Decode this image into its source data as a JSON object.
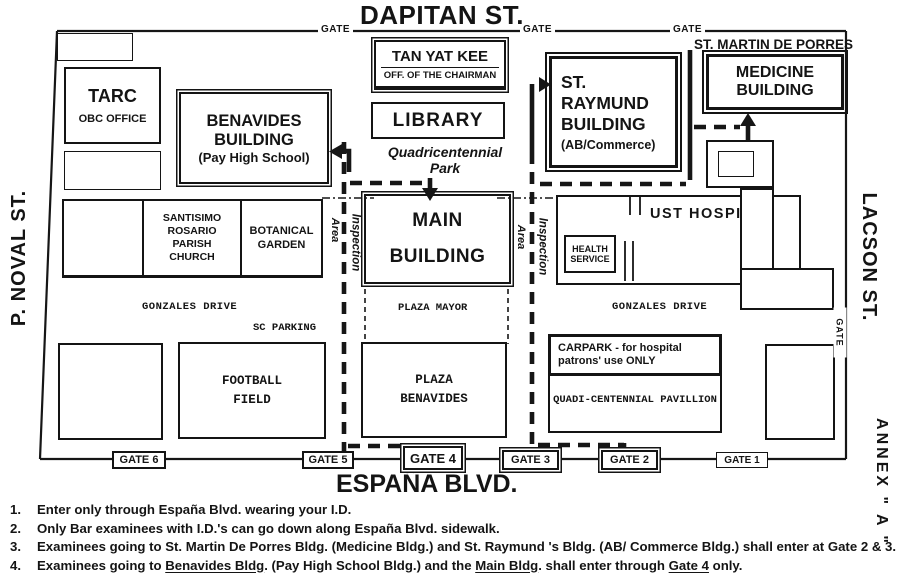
{
  "streets": {
    "top": "DAPITAN ST.",
    "bottom": "ESPAÑA BLVD.",
    "left": "P. NOVAL ST.",
    "right": "LACSON ST.",
    "annex": "ANNEX \" A \"",
    "side_gate": "GATE"
  },
  "top_gates": [
    "GATE",
    "GATE",
    "GATE"
  ],
  "buildings": {
    "tarc": {
      "line1": "TARC",
      "line2": "OBC OFFICE"
    },
    "benavides": {
      "line1": "BENAVIDES",
      "line2": "BUILDING",
      "line3": "(Pay High School)"
    },
    "tan_yat_kee": {
      "line1": "TAN YAT KEE",
      "line2": "OFF. OF THE CHAIRMAN"
    },
    "library": "LIBRARY",
    "st_raymund": {
      "line1": "ST.",
      "line2": "RAYMUND",
      "line3": "BUILDING",
      "line4": "(AB/Commerce)"
    },
    "st_martin": "ST. MARTIN DE PORRES",
    "medicine": {
      "line1": "MEDICINE",
      "line2": "BUILDING"
    },
    "main": {
      "line1": "MAIN",
      "line2": "BUILDING"
    },
    "church": {
      "line1": "SANTISIMO",
      "line2": "ROSARIO",
      "line3": "PARISH",
      "line4": "CHURCH"
    },
    "botanical": {
      "line1": "BOTANICAL",
      "line2": "GARDEN"
    },
    "hospital": "UST HOSPITAL",
    "health": {
      "line1": "HEALTH",
      "line2": "SERVICE"
    },
    "football": {
      "line1": "FOOTBALL",
      "line2": "FIELD"
    },
    "plaza_benavides": {
      "line1": "PLAZA",
      "line2": "BENAVIDES"
    },
    "carpark": {
      "line1": "CARPARK - for hospital",
      "line2": "patrons' use ONLY"
    },
    "pavilion": "QUADI-CENTENNIAL PAVILLION"
  },
  "areas": {
    "quadri_line1": "Quadricentennial",
    "quadri_line2": "Park",
    "gonzales": "GONZALES DRIVE",
    "sc_parking": "SC PARKING",
    "plaza_mayor": "PLAZA MAYOR",
    "inspection": "Inspection",
    "area": "Area"
  },
  "gates_bottom": [
    "GATE 6",
    "GATE 5",
    "GATE 4",
    "GATE 3",
    "GATE 2",
    "GATE 1"
  ],
  "notes": [
    {
      "num": "1.",
      "parts": [
        {
          "t": "Enter only through España Blvd. wearing your I.D."
        }
      ]
    },
    {
      "num": "2.",
      "parts": [
        {
          "t": "Only Bar examinees with I.D.'s can go down along España Blvd. sidewalk."
        }
      ]
    },
    {
      "num": "3.",
      "parts": [
        {
          "t": "Examinees going to St. Martin De Porres Bldg. (Medicine Bldg.) and St. Raymund 's Bldg. (AB/ Commerce Bldg.) shall enter at Gate 2 & 3."
        }
      ]
    },
    {
      "num": "4.",
      "parts": [
        {
          "t": "Examinees going to "
        },
        {
          "t": "Benavides Bldg",
          "u": true
        },
        {
          "t": ". (Pay High School Bldg.) and the "
        },
        {
          "t": "Main Bldg",
          "u": true
        },
        {
          "t": ". shall enter through "
        },
        {
          "t": "Gate 4",
          "u": true
        },
        {
          "t": " only."
        }
      ]
    }
  ],
  "ink": "#141414"
}
